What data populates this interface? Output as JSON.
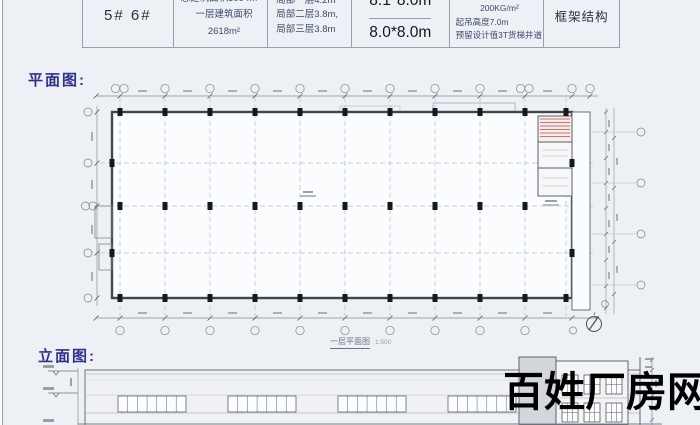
{
  "window": {
    "bg": "#edf0f5"
  },
  "spec_table": {
    "unit_no": "5# 6#",
    "total_area": "总建筑面积3094m²",
    "first_floor_area": "一层建筑面积2618m²",
    "storey_height_1": "局部一层4.2m",
    "storey_height_2": "局部二层3.8m,",
    "storey_height_3": "局部三层3.8m",
    "bay_size_top": "8.1*8.0m",
    "bay_size_bottom": "8.0*8.0m",
    "load_capacity": "二层、三层承载200KG/m²",
    "hook_height": "起吊高度7.0m",
    "freight_lift": "预留设计值3T货梯井道",
    "structure_type": "框架结构"
  },
  "plan_section": {
    "label": "平面图:",
    "caption": "一层平面图",
    "scale": "1:500"
  },
  "elevation_section": {
    "label": "立面图:"
  },
  "watermark": {
    "text": "百姓厂房网",
    "color": "#000000"
  },
  "icons": {
    "north_arrow": "north-arrow-icon"
  }
}
